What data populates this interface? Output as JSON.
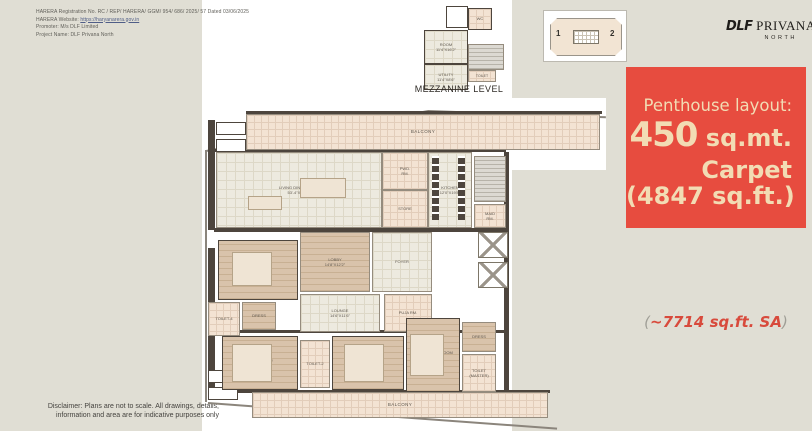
{
  "harera": {
    "line1": "HARERA Registration No. RC / REP/ HARERA/ GGM/ 954/ 686/ 2025/ 57 Dated 03/06/2025",
    "website_prefix": "HARERA Website: ",
    "website_link": "https://haryanarera.gov.in",
    "line3": "Promoter: M/s DLF Limited",
    "line4": "Project Name: DLF Privana North"
  },
  "disclaimer": {
    "line1": "Disclaimer: Plans are not to scale. All drawings, details,",
    "line2": "information and area are for indicative purposes only"
  },
  "logo": {
    "dlf": "DLF",
    "name": "PRIVANA",
    "sub": "NORTH"
  },
  "keyplan": {
    "unit_left": "1",
    "unit_right": "2"
  },
  "offer": {
    "intro": "Penthouse layout:",
    "area_value": "450",
    "area_unit": " sq.mt.",
    "carpet_label": "Carpet",
    "carpet_sqft": "(4847 sq.ft.)",
    "background": "#E74C3F",
    "text_color": "#F2DCB4"
  },
  "super_area": {
    "open": "(",
    "text": "~7714 sq.ft. SA",
    "close": ")"
  },
  "plan": {
    "mezzanine": {
      "caption": "MEZZANINE LEVEL",
      "rooms": [
        {
          "label": "ROOM\n11'4\"X16'2\""
        },
        {
          "label": "UTILITY\n11'4\"X8'6\""
        },
        {
          "label": "WC"
        },
        {
          "label": "TOILET"
        }
      ]
    },
    "main_rooms": [
      {
        "label": "BALCONY"
      },
      {
        "label": "LIVING DINING AREA\n53'-4\"X27'-2\""
      },
      {
        "label": "KITCHEN\n12'0\"X19'8\""
      },
      {
        "label": "PWD.\nRM."
      },
      {
        "label": "STORE"
      },
      {
        "label": "MAID\nRM."
      },
      {
        "label": "LOBBY\n14'8\"X12'2\""
      },
      {
        "label": "FOYER"
      },
      {
        "label": "BED ROOM-4\n12'6\"X16'1\""
      },
      {
        "label": "LOUNGE\n14'6\"X11'6\""
      },
      {
        "label": "PUJA RM."
      },
      {
        "label": "TOILET-4"
      },
      {
        "label": "DRESS"
      },
      {
        "label": "BED ROOM-2\n13'6\"X16'0\""
      },
      {
        "label": "TOILET-2"
      },
      {
        "label": "BED ROOM-3\n13'6\"X16'0\""
      },
      {
        "label": "MASTER BED ROOM\n14'0\"X20'2\""
      },
      {
        "label": "DRESS"
      },
      {
        "label": "TOILET\n(MASTER)"
      },
      {
        "label": "BALCONY"
      }
    ]
  }
}
